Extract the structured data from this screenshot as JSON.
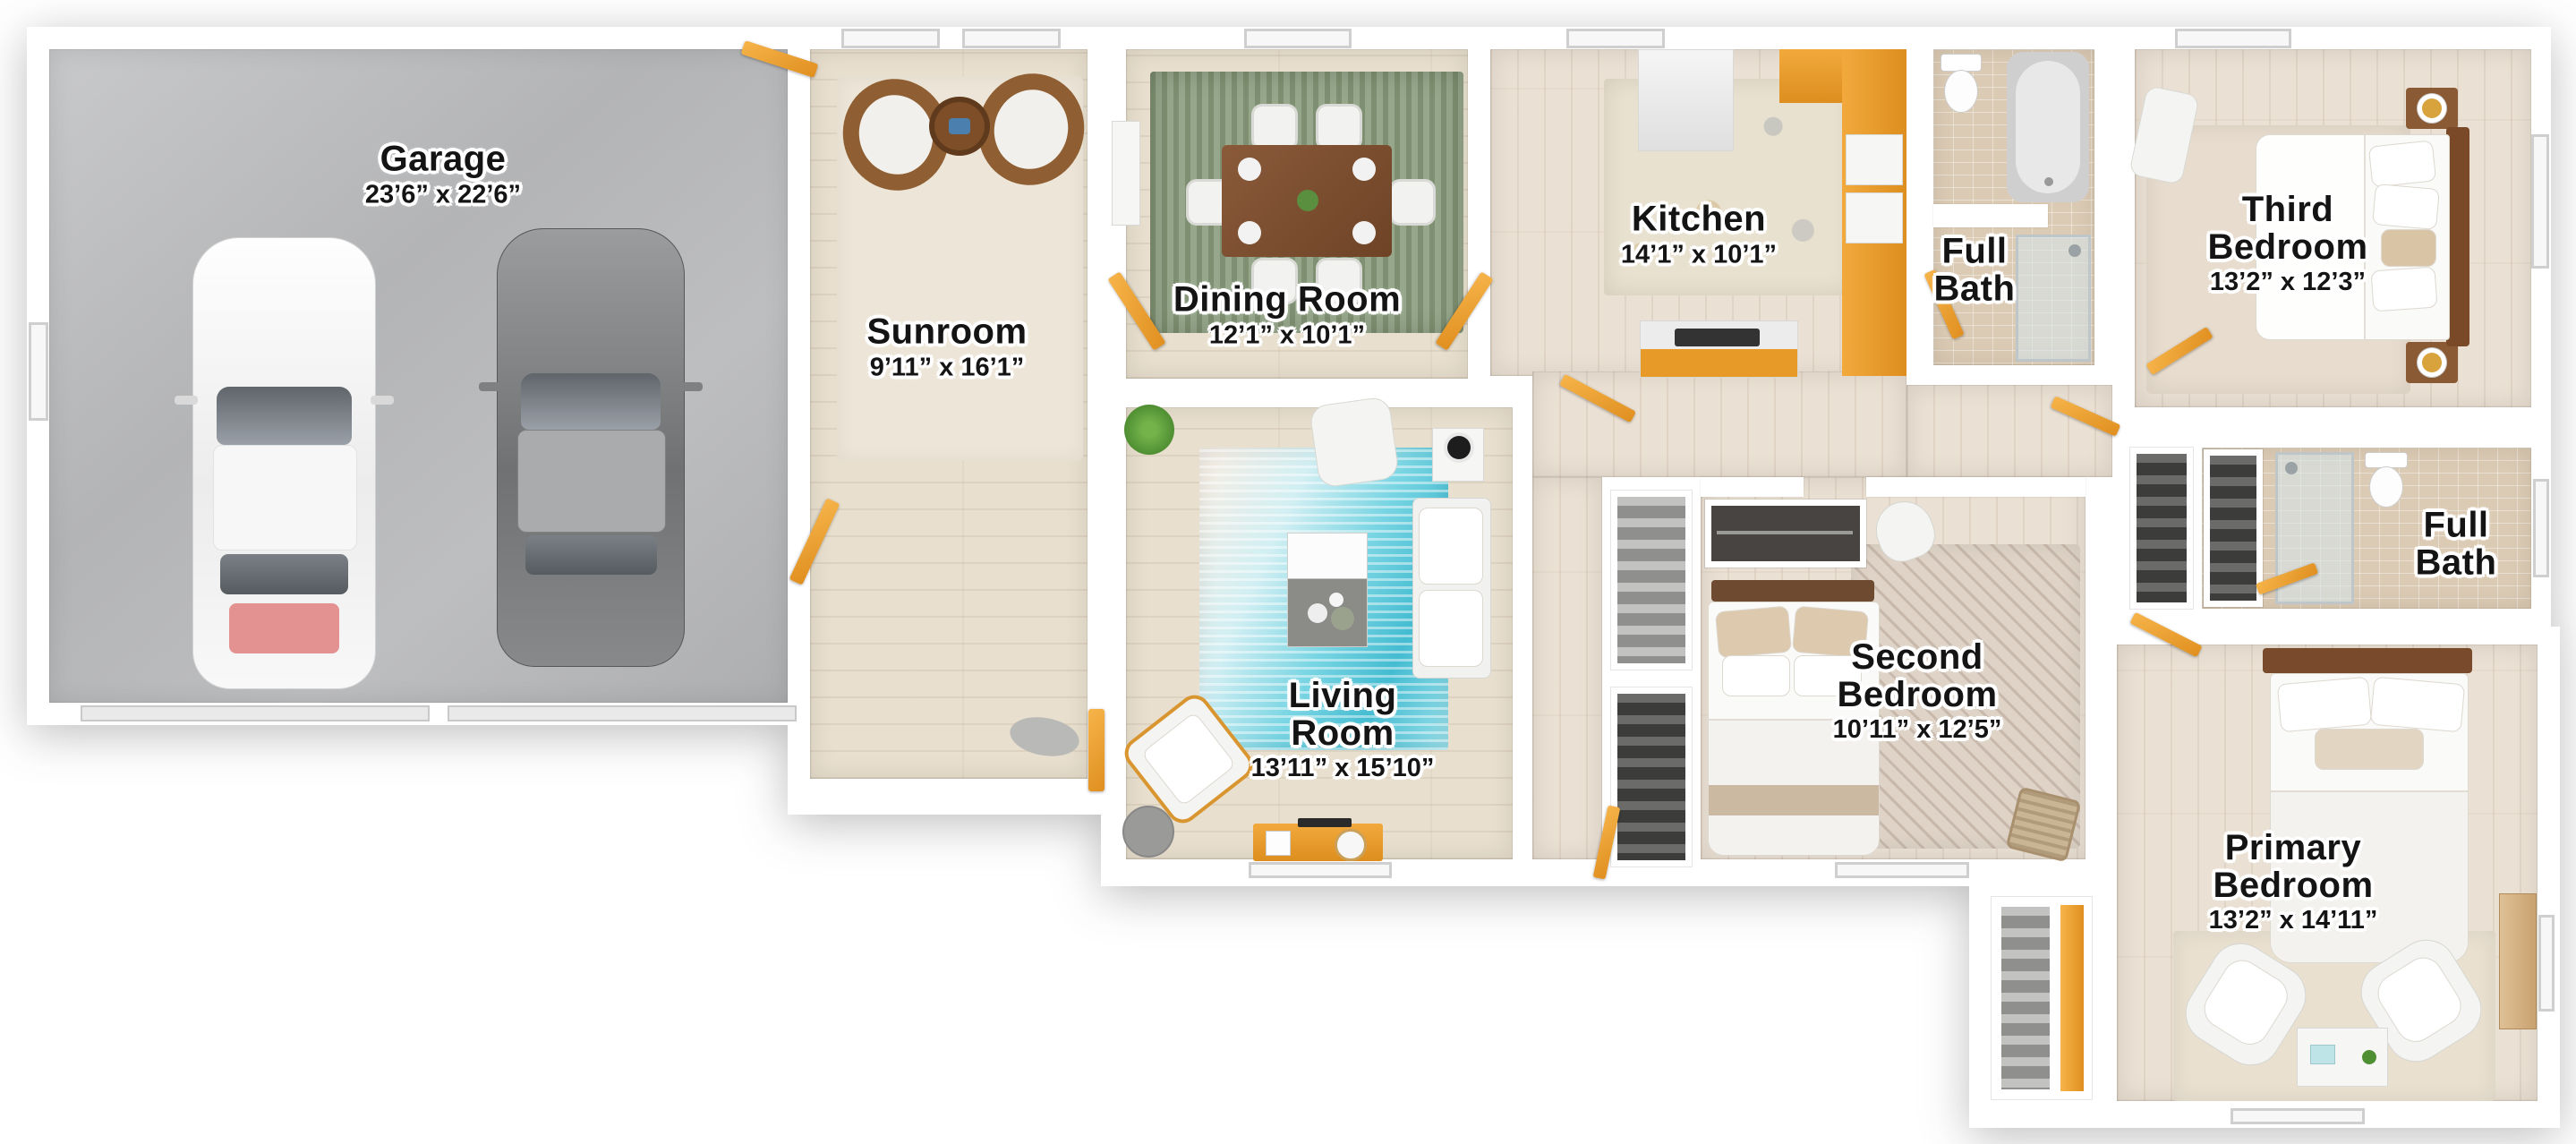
{
  "plan_title": "Single-story floor plan",
  "rooms": {
    "garage": {
      "name": "Garage",
      "dims": "23’6” x 22’6”"
    },
    "sunroom": {
      "name": "Sunroom",
      "dims": "9’11” x 16’1”"
    },
    "dining_room": {
      "name": "Dining Room",
      "dims": "12’1” x 10’1”"
    },
    "kitchen": {
      "name": "Kitchen",
      "dims": "14’1” x 10’1”"
    },
    "full_bath_upper": {
      "name": "Full Bath"
    },
    "third_bedroom": {
      "name": "Third Bedroom",
      "dims": "13’2” x 12’3”"
    },
    "living_room": {
      "name": "Living Room",
      "dims": "13’11” x 15’10”"
    },
    "second_bedroom": {
      "name": "Second Bedroom",
      "dims": "10’11” x 12’5”"
    },
    "full_bath_right": {
      "name": "Full Bath"
    },
    "primary_bedroom": {
      "name": "Primary Bedroom",
      "dims": "13’2” x 14’11”"
    }
  },
  "colors": {
    "wall": "#ffffff",
    "wood_floor": "#e8dfce",
    "garage_floor": "#b5b6b8",
    "bath_tile": "#dccbb4",
    "door_accent": "#e8962b",
    "living_rug_teal": "#4cc3d6",
    "dining_rug_green": "#8a9b7a",
    "label_text": "#141414"
  }
}
